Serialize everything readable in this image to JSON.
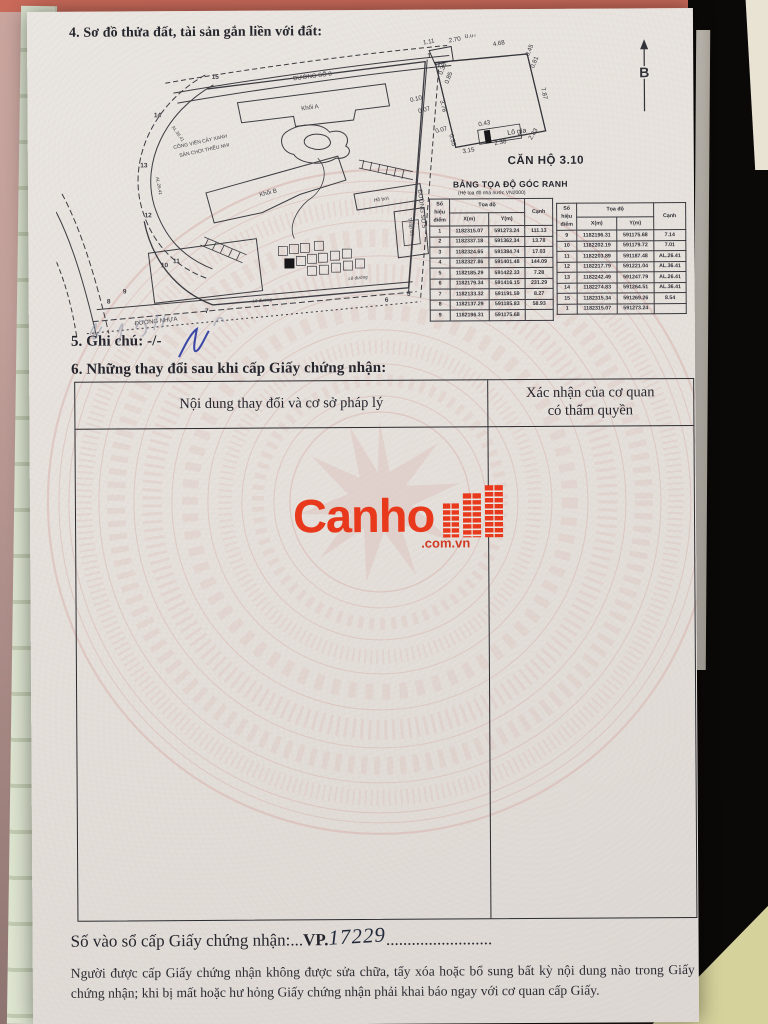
{
  "doc": {
    "section4_title": "4. Sơ đồ thửa đất, tài sản gắn liền với đất:",
    "section5_label": "5. Ghi chú: -/-",
    "section6_title": "6. Những thay đổi sau khi cấp Giấy chứng nhận:",
    "changes_table": {
      "col1_header": "Nội dung thay đổi và cơ sở pháp lý",
      "col2_header": "Xác nhận của cơ quan\ncó thẩm quyền"
    },
    "serial_line": {
      "label": "Số vào sổ cấp Giấy chứng nhận:",
      "dots_before": "...",
      "prefix": "VP.",
      "handwritten_number": "17229",
      "dots_after": "........................."
    },
    "footer_text": "Người được cấp Giấy chứng nhận không được sửa chữa, tẩy xóa hoặc bổ sung bất kỳ nội dung nào trong Giấy chứng nhận; khi bị mất hoặc hư hỏng Giấy chứng nhận phải khai báo ngay với cơ quan cấp Giấy."
  },
  "unit": {
    "title": "CĂN HỘ  3.10",
    "north_label": "B",
    "balcony_label": "Lô gia",
    "dims": [
      "1.11",
      "2.70",
      "0.07",
      "4.68",
      "0.45",
      "0.81",
      "7.87",
      "0.10",
      "0.07",
      "3.78",
      "0.07",
      "0.55",
      "3.15",
      "2.38",
      "2.83",
      "0.43",
      "0.38",
      "0.85"
    ]
  },
  "coord_table": {
    "title": "BẢNG TỌA ĐỘ GÓC RANH",
    "subtitle": "(Hệ tọa độ nhà nước VN2000)",
    "headers": {
      "point": "Số hiệu điểm",
      "coords": "Tọa độ",
      "x": "X(m)",
      "y": "Y(m)",
      "edge": "Cạnh"
    },
    "left_rows": [
      [
        "1",
        "1182315.07",
        "591273.24",
        "111.13"
      ],
      [
        "2",
        "1182337.18",
        "591362.34",
        "13.78"
      ],
      [
        "3",
        "1182324.65",
        "591384.74",
        "17.03"
      ],
      [
        "4",
        "1182327.86",
        "591401.48",
        "144.09"
      ],
      [
        "5",
        "1182185.29",
        "591422.33",
        "7.28"
      ],
      [
        "6",
        "1182179.34",
        "591416.15",
        "231.29"
      ],
      [
        "7",
        "1182133.32",
        "591191.59",
        "8.27"
      ],
      [
        "8",
        "1182137.29",
        "591185.83",
        "58.93"
      ],
      [
        "9",
        "1182196.31",
        "591175.68",
        ""
      ]
    ],
    "right_rows": [
      [
        "9",
        "1182196.31",
        "591175.68",
        "7.14"
      ],
      [
        "10",
        "1182202.19",
        "591179.72",
        "7.01"
      ],
      [
        "11",
        "1182203.89",
        "591187.48",
        "AL.26.41"
      ],
      [
        "12",
        "1182217.79",
        "591221.04",
        "AL.36.41"
      ],
      [
        "13",
        "1182242.49",
        "591247.79",
        "AL.26.41"
      ],
      [
        "14",
        "1182274.83",
        "591264.51",
        "AL.36.41"
      ],
      [
        "15",
        "1182315.34",
        "591269.26",
        "8.54"
      ],
      [
        "1",
        "1182315.07",
        "591273.24",
        ""
      ]
    ]
  },
  "map": {
    "road_top": "ĐƯỜNG SỐ 8",
    "road_right": "ĐƯỜNG SỐ 5",
    "road_bottom": "ĐƯỜNG NHỰA",
    "curb": "Lề đường",
    "park_line1": "CÔNG VIÊN CÂY XANH",
    "park_line2": "SÂN CHƠI THIẾU NHI",
    "bldg_a": "Khối A",
    "bldg_b": "Khối B",
    "pool": "Hồ bơi",
    "tower": "Tháp B1",
    "arc_label1": "AL.36.41",
    "arc_label2": "AL.26.41",
    "points": [
      "15",
      "14",
      "13",
      "12",
      "11",
      "10",
      "9",
      "8",
      "7",
      "6",
      "5",
      "1"
    ]
  },
  "logo": {
    "word": "Canho",
    "suffix": ".com.vn",
    "color": "#e8391d"
  }
}
